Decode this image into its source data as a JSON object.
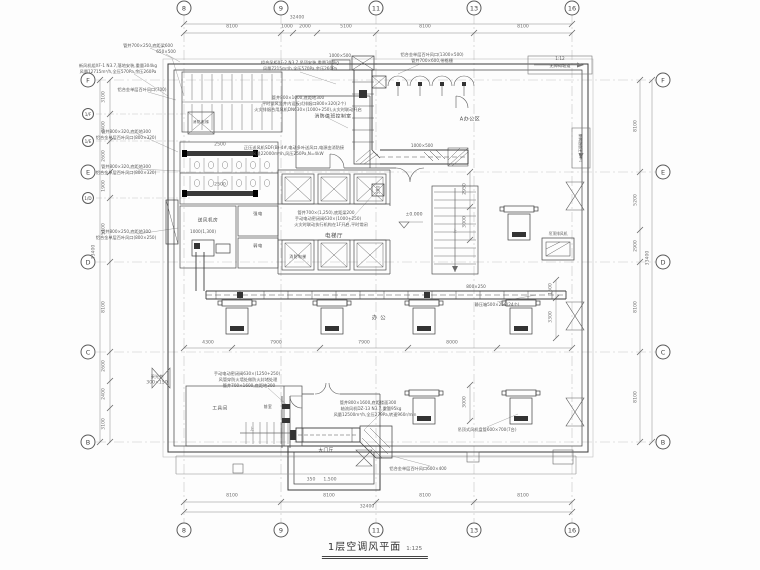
{
  "meta": {
    "drawing_title": "1层空调风平面",
    "scale": "1:125"
  },
  "grid": {
    "top": [
      {
        "label": "8",
        "x": 184
      },
      {
        "label": "9",
        "x": 281
      },
      {
        "label": "11",
        "x": 376
      },
      {
        "label": "13",
        "x": 474
      },
      {
        "label": "16",
        "x": 572
      }
    ],
    "bottom": [
      {
        "label": "8",
        "x": 184
      },
      {
        "label": "9",
        "x": 281
      },
      {
        "label": "11",
        "x": 376
      },
      {
        "label": "13",
        "x": 474
      },
      {
        "label": "16",
        "x": 572
      }
    ],
    "left": [
      {
        "label": "F",
        "y": 80
      },
      {
        "label": "1/F",
        "y": 114,
        "small": true
      },
      {
        "label": "1/E",
        "y": 141,
        "small": true
      },
      {
        "label": "E",
        "y": 172
      },
      {
        "label": "1/D",
        "y": 198,
        "small": true
      },
      {
        "label": "D",
        "y": 262
      },
      {
        "label": "C",
        "y": 352
      },
      {
        "label": "B",
        "y": 442
      }
    ],
    "right": [
      {
        "label": "F",
        "y": 80
      },
      {
        "label": "E",
        "y": 172
      },
      {
        "label": "D",
        "y": 262
      },
      {
        "label": "C",
        "y": 352
      },
      {
        "label": "B",
        "y": 442
      }
    ]
  },
  "dimensions": [
    {
      "t": "32400",
      "x": 297,
      "y": 19
    },
    {
      "t": "8100",
      "x": 232,
      "y": 28
    },
    {
      "t": "1000",
      "x": 287,
      "y": 28
    },
    {
      "t": "2000",
      "x": 305,
      "y": 28
    },
    {
      "t": "5100",
      "x": 346,
      "y": 28
    },
    {
      "t": "8100",
      "x": 425,
      "y": 28
    },
    {
      "t": "8100",
      "x": 523,
      "y": 28
    },
    {
      "t": "8100",
      "x": 232,
      "y": 497
    },
    {
      "t": "8100",
      "x": 329,
      "y": 497
    },
    {
      "t": "8100",
      "x": 425,
      "y": 497
    },
    {
      "t": "8100",
      "x": 523,
      "y": 497
    },
    {
      "t": "32400",
      "x": 367,
      "y": 508
    },
    {
      "t": "3100",
      "x": 105,
      "y": 97,
      "r": 1
    },
    {
      "t": "2400",
      "x": 105,
      "y": 127,
      "r": 1
    },
    {
      "t": "2600",
      "x": 105,
      "y": 156,
      "r": 1
    },
    {
      "t": "1900",
      "x": 105,
      "y": 186,
      "r": 1
    },
    {
      "t": "5100",
      "x": 105,
      "y": 229,
      "r": 1
    },
    {
      "t": "8100",
      "x": 105,
      "y": 307,
      "r": 1
    },
    {
      "t": "2600",
      "x": 105,
      "y": 366,
      "r": 1
    },
    {
      "t": "2400",
      "x": 105,
      "y": 394,
      "r": 1
    },
    {
      "t": "3100",
      "x": 105,
      "y": 424,
      "r": 1
    },
    {
      "t": "33400",
      "x": 95,
      "y": 252,
      "r": 1
    },
    {
      "t": "8100",
      "x": 637,
      "y": 126,
      "r": 1
    },
    {
      "t": "5200",
      "x": 637,
      "y": 200,
      "r": 1
    },
    {
      "t": "2900",
      "x": 637,
      "y": 246,
      "r": 1
    },
    {
      "t": "8100",
      "x": 637,
      "y": 307,
      "r": 1
    },
    {
      "t": "8100",
      "x": 637,
      "y": 397,
      "r": 1
    },
    {
      "t": "33400",
      "x": 649,
      "y": 258,
      "r": 1
    },
    {
      "t": "4300",
      "x": 208,
      "y": 344
    },
    {
      "t": "7900",
      "x": 276,
      "y": 344
    },
    {
      "t": "7900",
      "x": 364,
      "y": 344
    },
    {
      "t": "8000",
      "x": 452,
      "y": 344
    },
    {
      "t": "2950",
      "x": 466,
      "y": 189,
      "r": 1
    },
    {
      "t": "3000",
      "x": 466,
      "y": 222,
      "r": 1
    },
    {
      "t": "3000",
      "x": 466,
      "y": 402,
      "r": 1
    },
    {
      "t": "1500",
      "x": 552,
      "y": 289,
      "r": 1
    },
    {
      "t": "3300",
      "x": 552,
      "y": 317,
      "r": 1
    },
    {
      "t": "2500",
      "x": 220,
      "y": 146
    },
    {
      "t": "2500",
      "x": 220,
      "y": 186
    },
    {
      "t": "500",
      "x": 380,
      "y": 190,
      "r": 1
    },
    {
      "t": "350",
      "x": 311,
      "y": 481
    },
    {
      "t": "1,500",
      "x": 330,
      "y": 481
    },
    {
      "t": "300×150",
      "x": 157,
      "y": 384
    }
  ],
  "rooms": [
    {
      "name": "room-elevator-hall",
      "t": "电梯厅",
      "x": 334,
      "y": 237,
      "s": 5.5
    },
    {
      "name": "room-fire-elevator",
      "t": "消防电梯",
      "x": 298,
      "y": 257,
      "s": 3.8
    },
    {
      "name": "room-fire-elevator-2",
      "t": "消防电梯",
      "x": 201,
      "y": 123,
      "s": 3.6
    },
    {
      "name": "room-fire-duty",
      "t": "消防值班控制室",
      "x": 333,
      "y": 118,
      "s": 4.8
    },
    {
      "name": "room-office-zone",
      "t": "A办公区",
      "x": 470,
      "y": 120,
      "s": 5
    },
    {
      "name": "room-supply-fan",
      "t": "送风机房",
      "x": 208,
      "y": 222,
      "s": 4.6
    },
    {
      "name": "room-strong-elec",
      "t": "强电",
      "x": 258,
      "y": 214,
      "s": 4.2
    },
    {
      "name": "room-weak-elec",
      "t": "弱电",
      "x": 258,
      "y": 246,
      "s": 4.2
    },
    {
      "name": "room-tools",
      "t": "工具间",
      "x": 220,
      "y": 410,
      "s": 4.6
    },
    {
      "name": "room-main-lobby",
      "t": "大门厅",
      "x": 326,
      "y": 452,
      "s": 4.6
    },
    {
      "name": "room-antechamber",
      "t": "前室",
      "x": 268,
      "y": 407,
      "s": 3.8
    },
    {
      "name": "room-office",
      "t": "办 公",
      "x": 379,
      "y": 319,
      "s": 5.5
    }
  ],
  "annotations": [
    {
      "t": "管井700×250,底距梁600",
      "x": 148,
      "y": 46
    },
    {
      "t": "650×500",
      "x": 166,
      "y": 52
    },
    {
      "t": "新风机组XF-1 N3.7,落地安装,重量304kg",
      "x": 118,
      "y": 66
    },
    {
      "t": "风量12715m³/h,全压570Pa,余压260Pa",
      "x": 118,
      "y": 72
    },
    {
      "t": "铝合金单层百叶风口(700)",
      "x": 142,
      "y": 90
    },
    {
      "t": "管井800×320,底距地300",
      "x": 126,
      "y": 132
    },
    {
      "t": "铝合金单层百叶风口(800×320)",
      "x": 126,
      "y": 138
    },
    {
      "t": "管井800×320,底距地300",
      "x": 126,
      "y": 167
    },
    {
      "t": "铝合金单层百叶风口(800×320)",
      "x": 126,
      "y": 173
    },
    {
      "t": "管井800×250,底距地300",
      "x": 126,
      "y": 232
    },
    {
      "t": "铝合金单层百叶风口(800×250)",
      "x": 126,
      "y": 238
    },
    {
      "t": "组合风柜XF-2 N3.7,吊顶安装,重量304kg",
      "x": 300,
      "y": 63
    },
    {
      "t": "风量7215m³/h,全压570Pa,余压260Pa",
      "x": 300,
      "y": 69
    },
    {
      "t": "1000×500",
      "x": 340,
      "y": 56
    },
    {
      "t": "铝合金单层百叶风口(1300×500)",
      "x": 432,
      "y": 55
    },
    {
      "t": "管井700×600,带格栅",
      "x": 432,
      "y": 61
    },
    {
      "t": "管井800×1000,底距地300",
      "x": 298,
      "y": 98
    },
    {
      "t": "平时排风竖井内设板式排烟口800×320(2个)",
      "x": 304,
      "y": 104
    },
    {
      "t": "火灾排烟合用风机DN630×(1000+250),火灾时联动开启",
      "x": 308,
      "y": 110
    },
    {
      "t": "正压送风机SDF(B)-4#,电动多叶送风口,电源由消防接",
      "x": 294,
      "y": 148
    },
    {
      "t": "风量22000m³/h,风压250Pa,N=4kW",
      "x": 288,
      "y": 154
    },
    {
      "t": "管井700×(1,250),底距梁200",
      "x": 326,
      "y": 213
    },
    {
      "t": "手动电动密闭阀630×(1000+250)",
      "x": 328,
      "y": 219
    },
    {
      "t": "火灾时联动执行机构在1F开启,平时常闭",
      "x": 331,
      "y": 225
    },
    {
      "t": "1000(1,300)",
      "x": 203,
      "y": 232
    },
    {
      "t": "静压箱500×250(24个)",
      "x": 497,
      "y": 305
    },
    {
      "t": "800×250",
      "x": 476,
      "y": 287
    },
    {
      "t": "1000×500",
      "x": 422,
      "y": 146
    },
    {
      "t": "±0.000",
      "x": 414,
      "y": 216,
      "s": 4.6
    },
    {
      "t": "手动电动密闭阀630×(1250+250)",
      "x": 247,
      "y": 374
    },
    {
      "t": "风管穿防火墙处做防火封堵处理",
      "x": 248,
      "y": 380
    },
    {
      "t": "管井700×1600,底距地300",
      "x": 249,
      "y": 386
    },
    {
      "t": "管井800×1600,底距楼面300",
      "x": 368,
      "y": 403
    },
    {
      "t": "轴流风机DZ-13 N3.7,重量95kg",
      "x": 371,
      "y": 409
    },
    {
      "t": "风量12500m³/h,全压279Pa,转速960r/min",
      "x": 375,
      "y": 415
    },
    {
      "t": "吊顶式风机盘管600×700(7台)",
      "x": 487,
      "y": 430
    },
    {
      "t": "铝合金单层百叶风口600×400",
      "x": 418,
      "y": 469
    },
    {
      "t": "采光井",
      "x": 157,
      "y": 377
    },
    {
      "t": "1:12",
      "x": 560,
      "y": 59
    },
    {
      "t": "无障碍坡道",
      "x": 560,
      "y": 66
    },
    {
      "t": "1:12 无障碍坡道",
      "x": 581,
      "y": 148,
      "r": 1,
      "s": 3.8
    },
    {
      "t": "吊顶排风机",
      "x": 558,
      "y": 234,
      "s": 3.8
    },
    {
      "t": "上",
      "x": 252,
      "y": 429,
      "s": 4
    },
    {
      "t": "上",
      "x": 455,
      "y": 231,
      "s": 4
    }
  ]
}
